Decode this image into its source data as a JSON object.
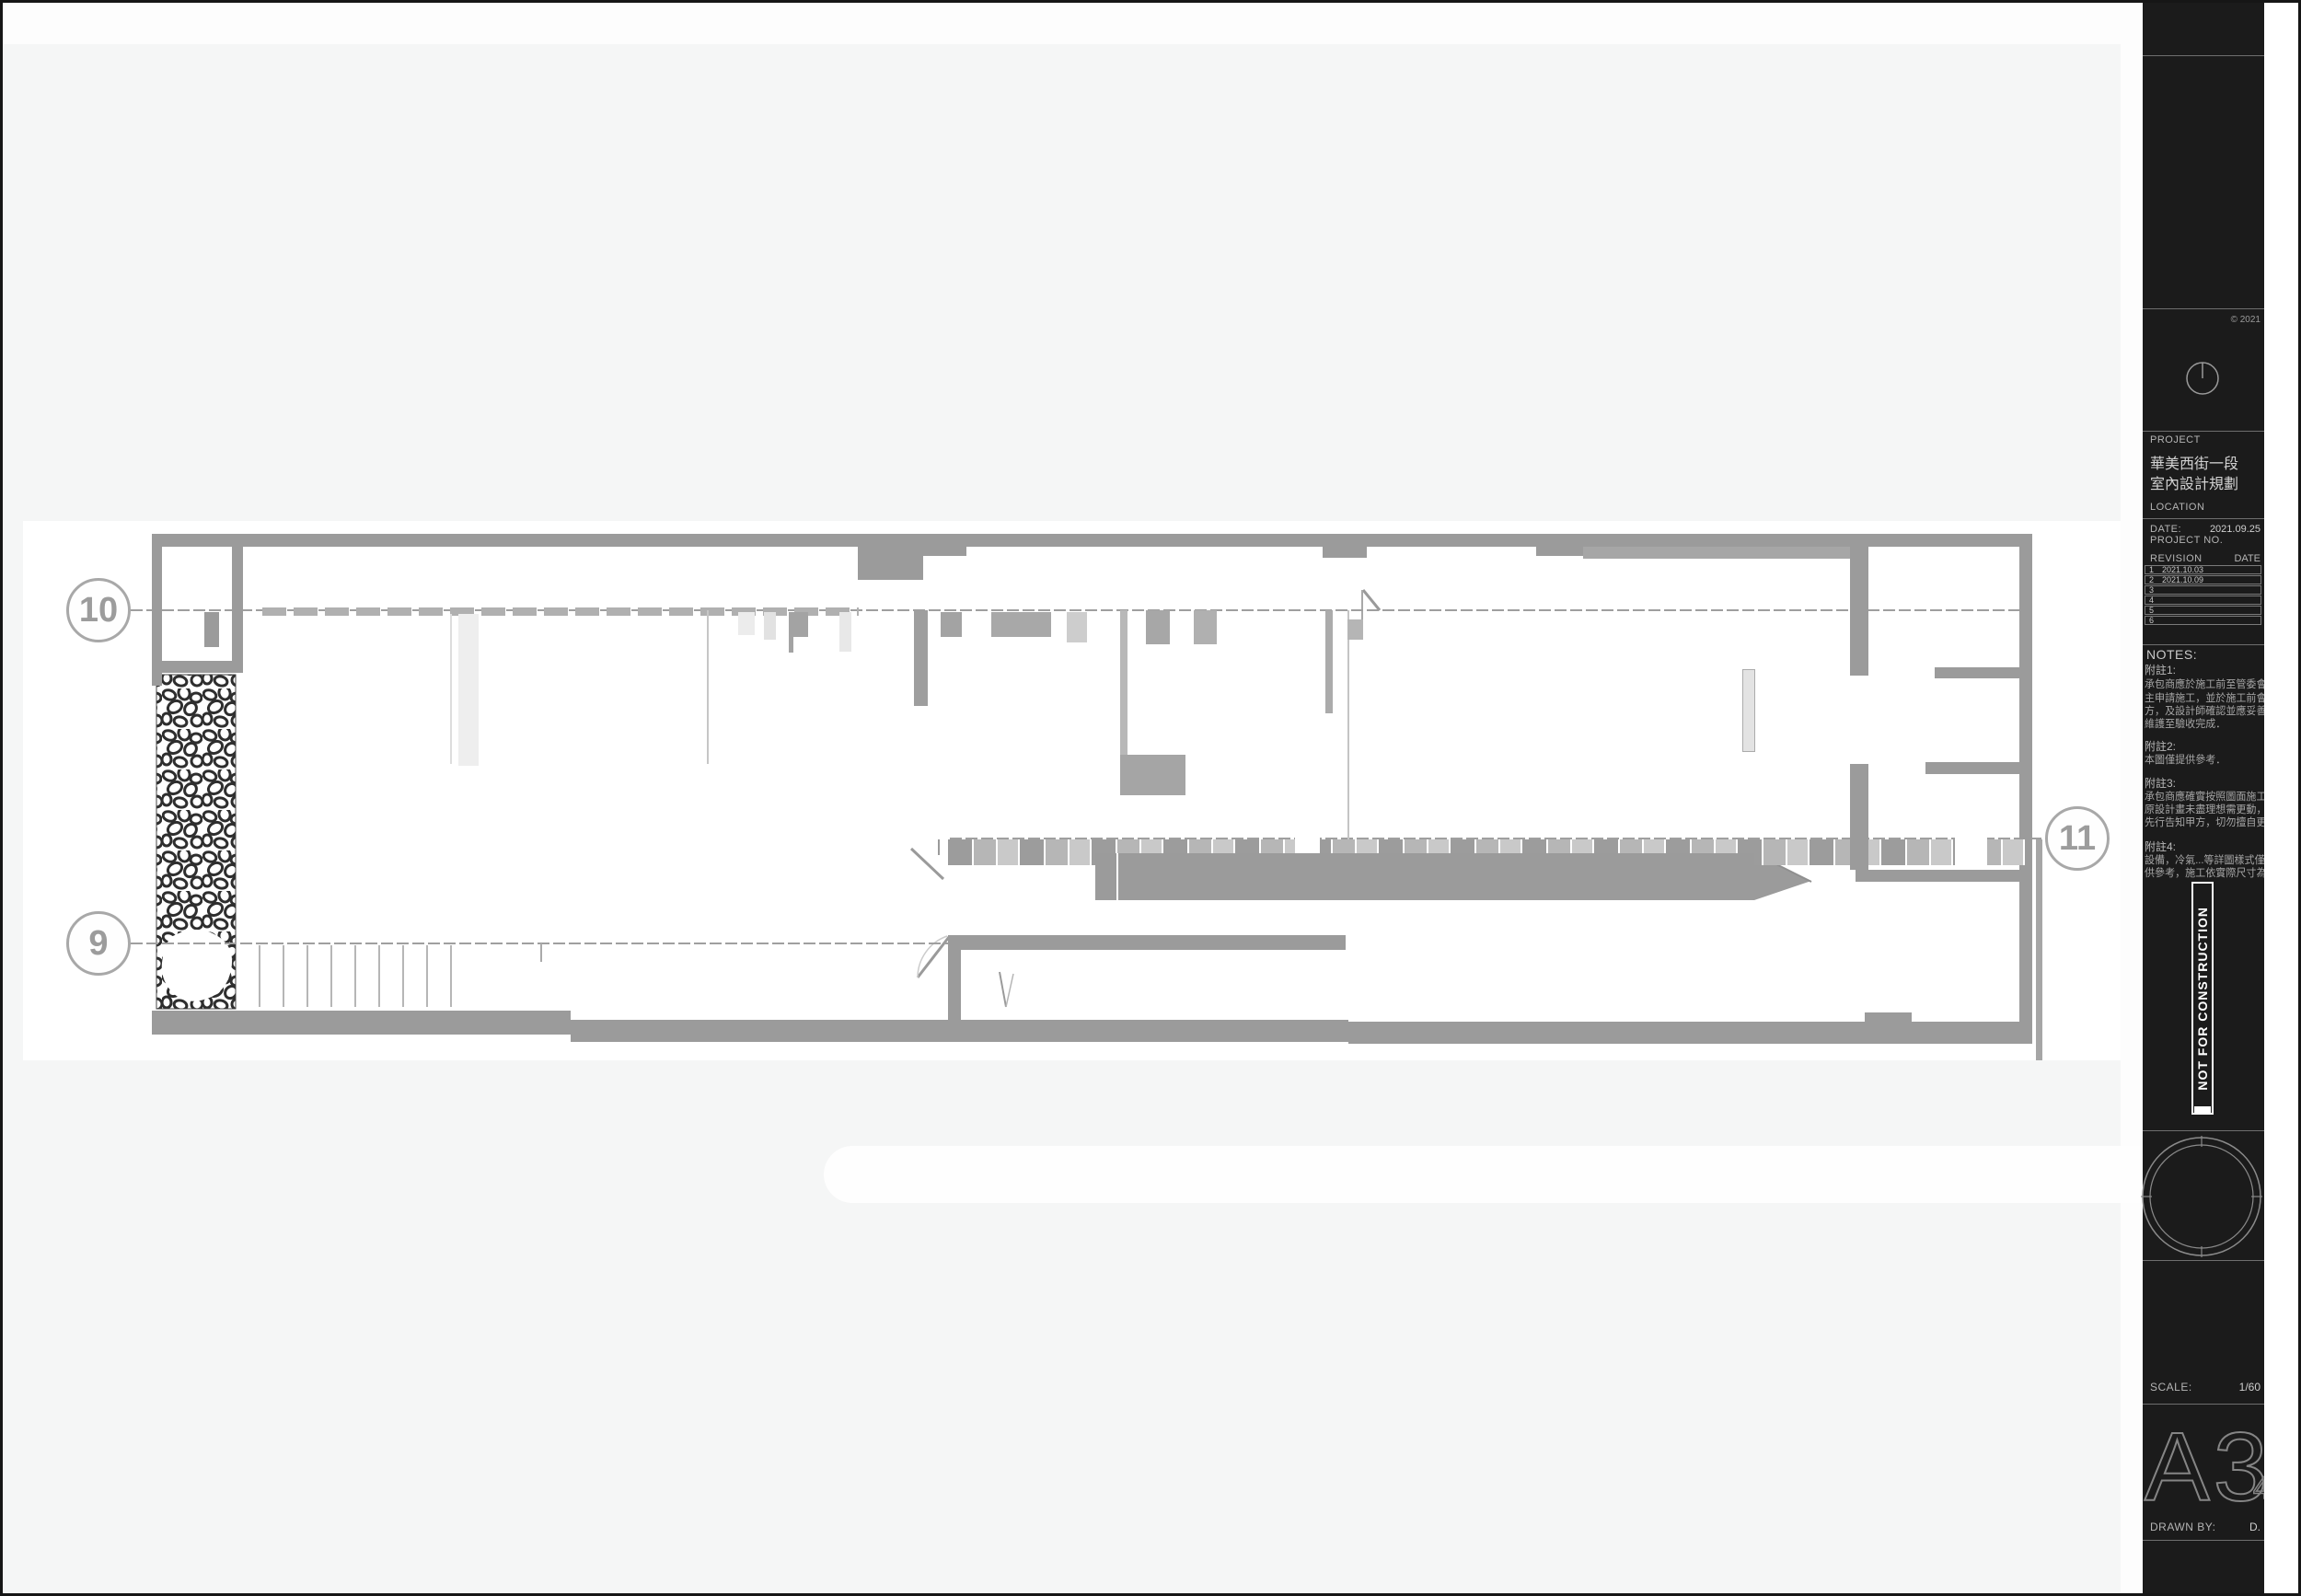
{
  "plan": {
    "bubble_left_top": "10",
    "bubble_left_bottom": "9",
    "bubble_right": "11"
  },
  "titleblock": {
    "copyright": "© 2021",
    "project_label": "PROJECT",
    "project_name_line1": "華美西街一段",
    "project_name_line2": "室內設計規劃",
    "location_label": "LOCATION",
    "date_label": "DATE:",
    "date_value": "2021.09.25",
    "project_no_label": "PROJECT NO.",
    "revision": {
      "col_rev": "REVISION",
      "col_date": "DATE",
      "rows": [
        {
          "no": "1",
          "date": "2021.10.03"
        },
        {
          "no": "2",
          "date": "2021.10.09"
        },
        {
          "no": "3",
          "date": ""
        },
        {
          "no": "4",
          "date": ""
        },
        {
          "no": "5",
          "date": ""
        },
        {
          "no": "6",
          "date": ""
        }
      ]
    },
    "notes_label": "NOTES:",
    "notes": [
      {
        "head": "附註1:",
        "lines": [
          "承包商應於施工前至管委會或屋",
          "主申請施工，並於施工前會同甲",
          "方，及設計師確認並應妥善管理",
          "維護至驗收完成．"
        ]
      },
      {
        "head": "附註2:",
        "lines": [
          "本圖僅提供參考．"
        ]
      },
      {
        "head": "附註3:",
        "lines": [
          "承包商應確實按照圖面施工，若",
          "原設計畫未盡理想需更動，請務必",
          "先行告知甲方，切勿擅自更改．"
        ]
      },
      {
        "head": "附註4:",
        "lines": [
          "設備，冷氣...等詳圖樣式僅提",
          "供參考，施工依實際尺寸為主．"
        ]
      }
    ],
    "stamp_text": "NOT FOR CONSTRUCTION",
    "scale_label": "SCALE:",
    "scale_value": "1/60",
    "sheet_number": "A3.",
    "drawn_by_label": "DRAWN BY:",
    "drawn_by_value": "D."
  },
  "colors": {
    "wall_gray": "#9b9b9b",
    "grid_line_gray": "#9f9f9f",
    "panel_bg": "#1b1b1b",
    "panel_text": "#b5b5b5",
    "sheet_bg": "#f5f6f6",
    "plan_bg": "#ffffff",
    "hatch_stroke": "#2e2e2e"
  }
}
